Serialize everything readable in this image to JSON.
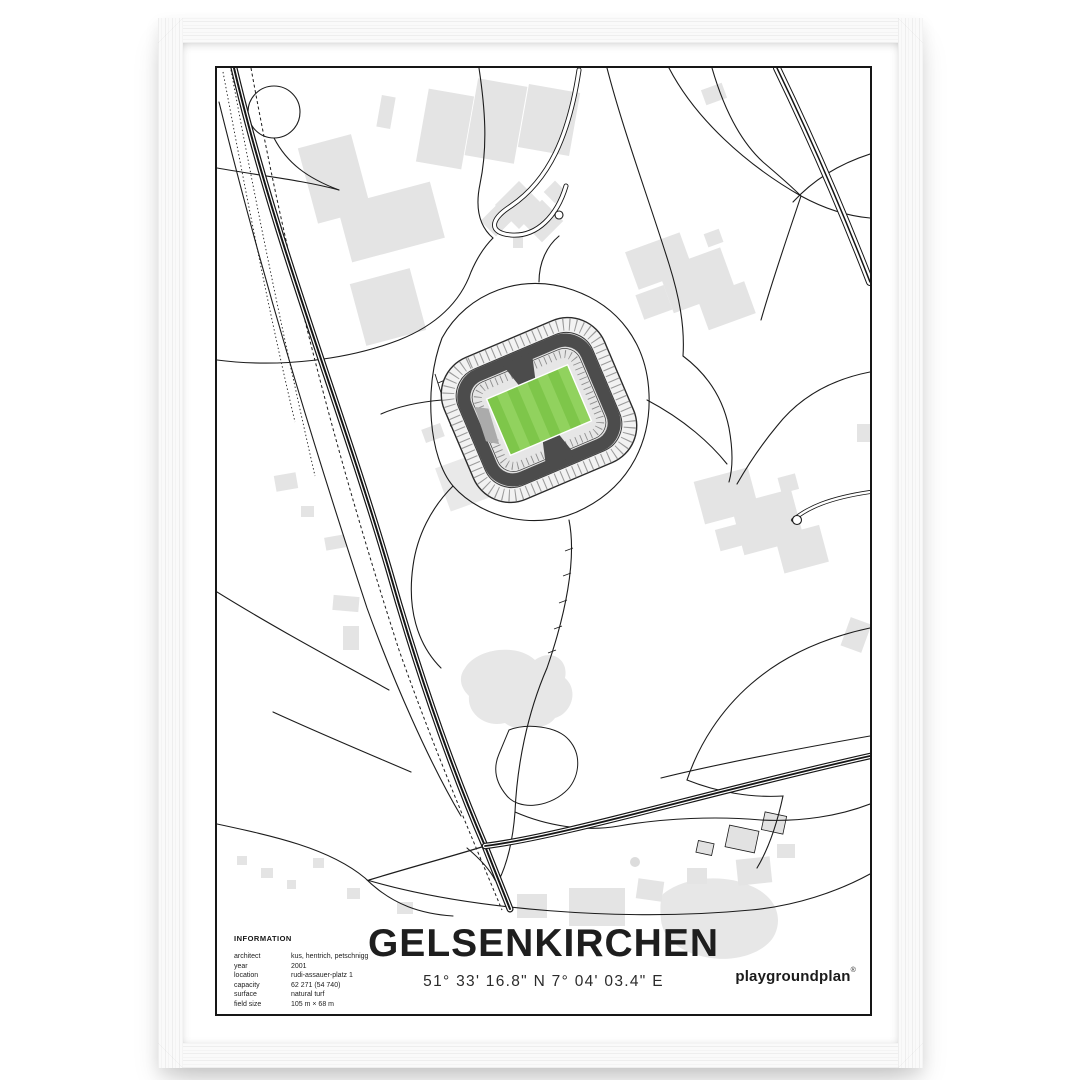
{
  "poster": {
    "title": "GELSENKIRCHEN",
    "coordinates": "51° 33' 16.8\" N  7° 04' 03.4\" E",
    "brand": {
      "name": "playgroundplan",
      "mark": "®"
    },
    "info": {
      "heading": "INFORMATION",
      "rows": [
        {
          "label": "architect",
          "value": "kus, hentrich, petschnigg"
        },
        {
          "label": "year",
          "value": "2001"
        },
        {
          "label": "location",
          "value": "rudi-assauer-platz 1"
        },
        {
          "label": "capacity",
          "value": "62 271 (54 740)"
        },
        {
          "label": "surface",
          "value": "natural turf"
        },
        {
          "label": "field size",
          "value": "105 m × 68 m"
        }
      ]
    }
  },
  "map": {
    "subject": "street map of Gelsenkirchen around the Veltins-Arena stadium",
    "stadium": "Veltins-Arena",
    "colors": {
      "pitch_green": "#7ec64a",
      "pitch_green_light": "#91d25e",
      "building_gray": "#e4e4e4",
      "road_black": "#1c1c1c",
      "stand_dark": "#4c4c4c"
    }
  },
  "frame": {
    "style": "white-wood-frame",
    "mat": "white"
  }
}
